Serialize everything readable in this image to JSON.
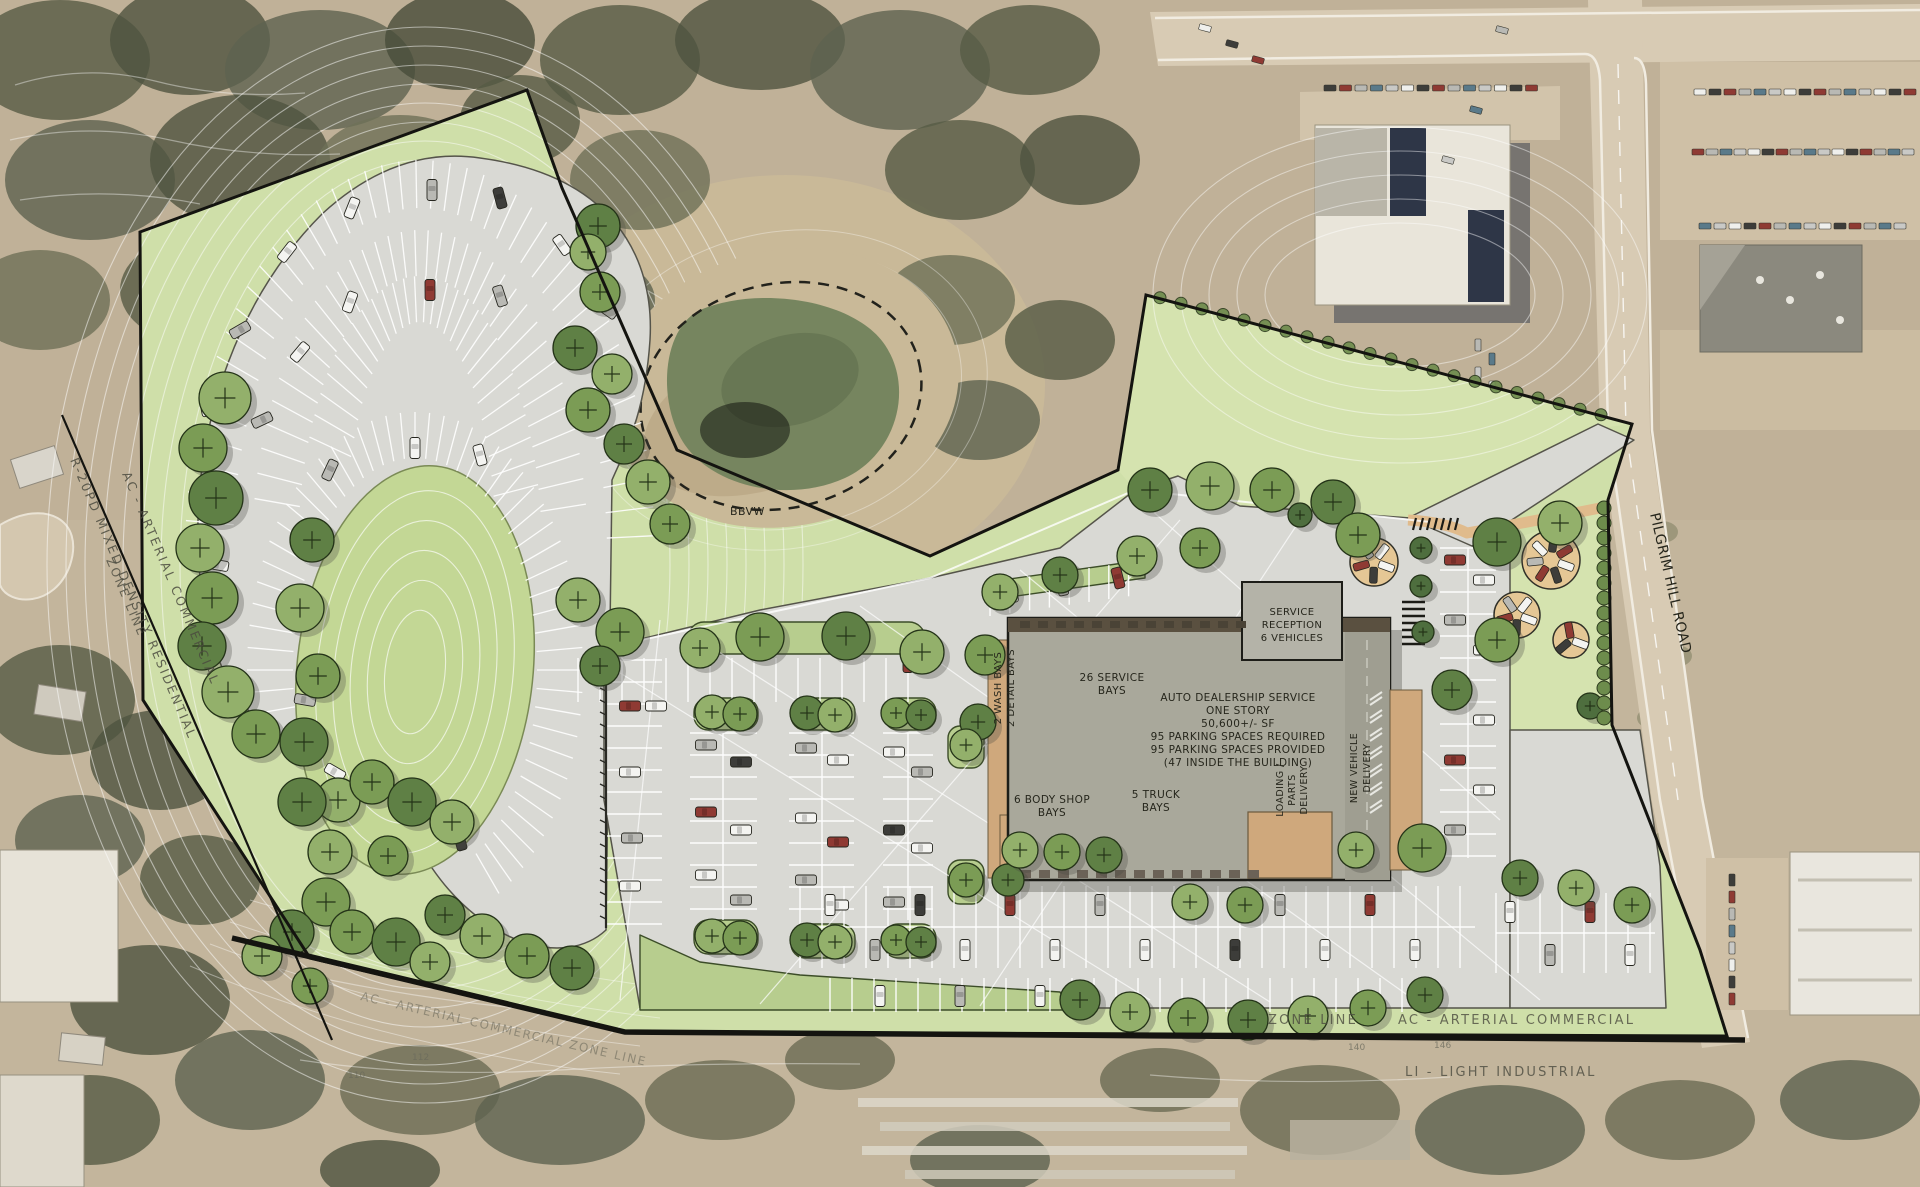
{
  "building": {
    "info_lines": [
      "AUTO DEALERSHIP SERVICE",
      "ONE STORY",
      "50,600+/- SF",
      "95 PARKING SPACES REQUIRED",
      "95 PARKING SPACES PROVIDED",
      "(47 INSIDE THE BUILDING)"
    ],
    "service_bays": [
      "26 SERVICE",
      "BAYS"
    ],
    "reception": [
      "SERVICE",
      "RECEPTION",
      "6 VEHICLES"
    ],
    "wash_bays": [
      "2 WASH BAYS",
      "2 DETAIL BAYS"
    ],
    "body_shop": [
      "6 BODY SHOP",
      "BAYS"
    ],
    "truck_bays": [
      "5 TRUCK",
      "BAYS"
    ],
    "loading": [
      "LOADING /",
      "PARTS",
      "DELIVERY"
    ],
    "new_vehicle": [
      "NEW VEHICLE",
      "DELIVERY"
    ]
  },
  "roads": {
    "pilgrim_hill": "PILGRIM HILL ROAD"
  },
  "zoning": {
    "west_residential": "R-20PD  MIXED DENSITY RESIDENTIAL",
    "west_commercial": "AC - ARTERIAL COMMERCIAL",
    "west_line": "ZONE LINE",
    "south_line": "ZONE LINE",
    "south_commercial": "AC - ARTERIAL COMMERCIAL",
    "south_industrial": "LI - LIGHT INDUSTRIAL",
    "southwest_faint": "AC - ARTERIAL COMMERCIAL   ZONE LINE"
  },
  "wetland": {
    "label": "BBVW"
  },
  "contour_labels": [
    "140",
    "146",
    "112",
    "110"
  ],
  "colors": {
    "lawn": "#cfdfa9",
    "pavement": "#d9d9d4",
    "building": "#a9a89b",
    "apron_tan": "#cfa87c",
    "tree_green": "#7b9c55",
    "boundary": "#141410",
    "aerial_tan": "#c3b59c",
    "pond": "#76855f"
  }
}
